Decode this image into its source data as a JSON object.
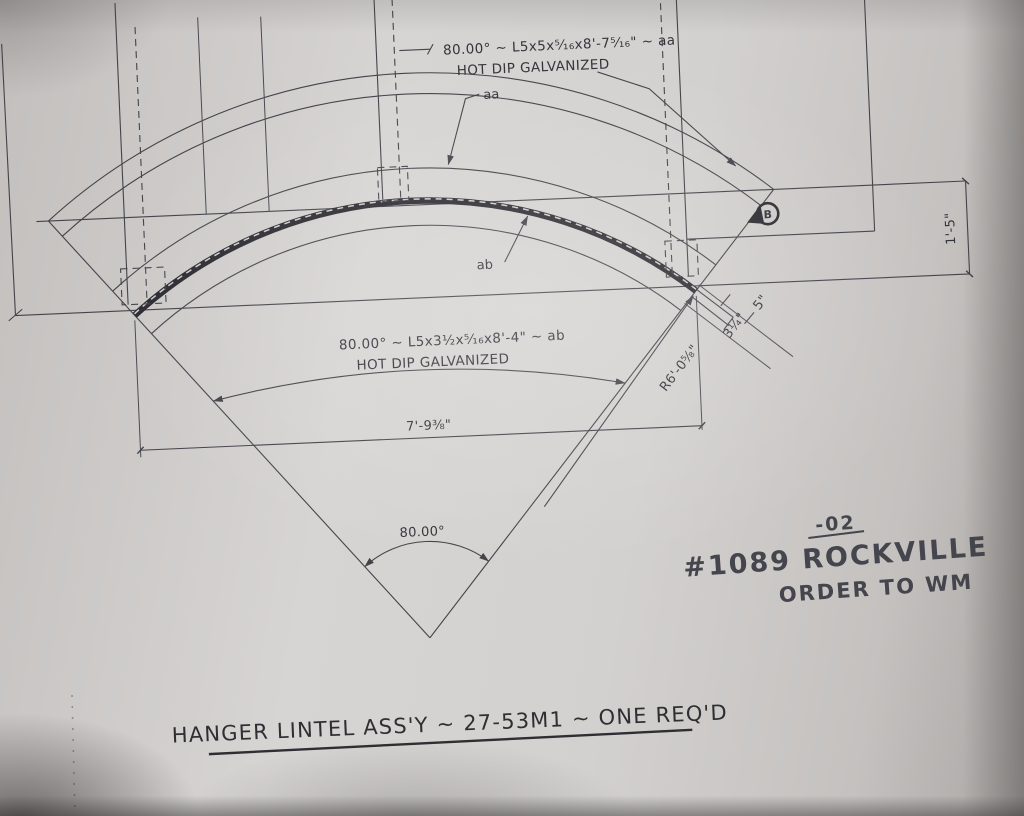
{
  "drawing": {
    "title": "HANGER LINTEL ASS'Y ~ 27-53M1 ~ ONE REQ'D",
    "notes": {
      "top_angle": {
        "line1": "80.00° ~ L5x5x⁵⁄₁₆x8'-7⁵⁄₁₆\" ~ aa",
        "line2": "HOT DIP GALVANIZED",
        "mark": "aa"
      },
      "bottom_angle": {
        "line1": "80.00° ~ L5x3½x⁵⁄₁₆x8'-4\" ~ ab",
        "line2": "HOT DIP GALVANIZED",
        "mark": "ab"
      }
    },
    "dimensions": {
      "chord": "7'-9⅜\"",
      "angle": "80.00°",
      "radius": "R6'-0⅝\"",
      "height": "1'-5\"",
      "ext_small": "3¼\"",
      "ext_large": "5\""
    },
    "markers": {
      "section": "B"
    },
    "handwriting": {
      "rev": "-02",
      "line1": "#1089 ROCKVILLE",
      "line2": "ORDER TO WM"
    }
  },
  "colors": {
    "line": "#43434a",
    "heavy": "#2b2b31",
    "hand": "#45454e",
    "paper": "#d3d1cf"
  }
}
